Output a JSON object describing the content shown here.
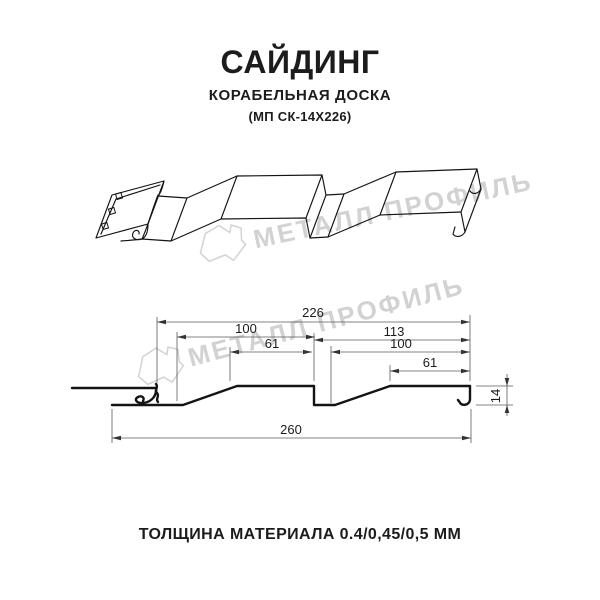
{
  "header": {
    "title": "САЙДИНГ",
    "subtitle": "КОРАБЕЛЬНАЯ ДОСКА",
    "model_code": "(МП СК-14Х226)"
  },
  "footer": {
    "thickness_note": "ТОЛЩИНА МАТЕРИАЛА 0.4/0,45/0,5 ММ"
  },
  "watermark": {
    "brand_text": "МЕТАЛЛ ПРОФИЛЬ",
    "color": "#cbcbcb"
  },
  "dimensions_mm": {
    "overall_width": "226",
    "left_board_width": "100",
    "left_board_flat": "61",
    "right_section_width": "113",
    "right_board_width": "100",
    "right_board_flat": "61",
    "total_panel_width": "260",
    "profile_height": "14"
  },
  "colors": {
    "profile_line": "#141414",
    "dimension_line": "#5a5a5a",
    "text": "#1c1c1c",
    "watermark": "#cbcbcb"
  }
}
